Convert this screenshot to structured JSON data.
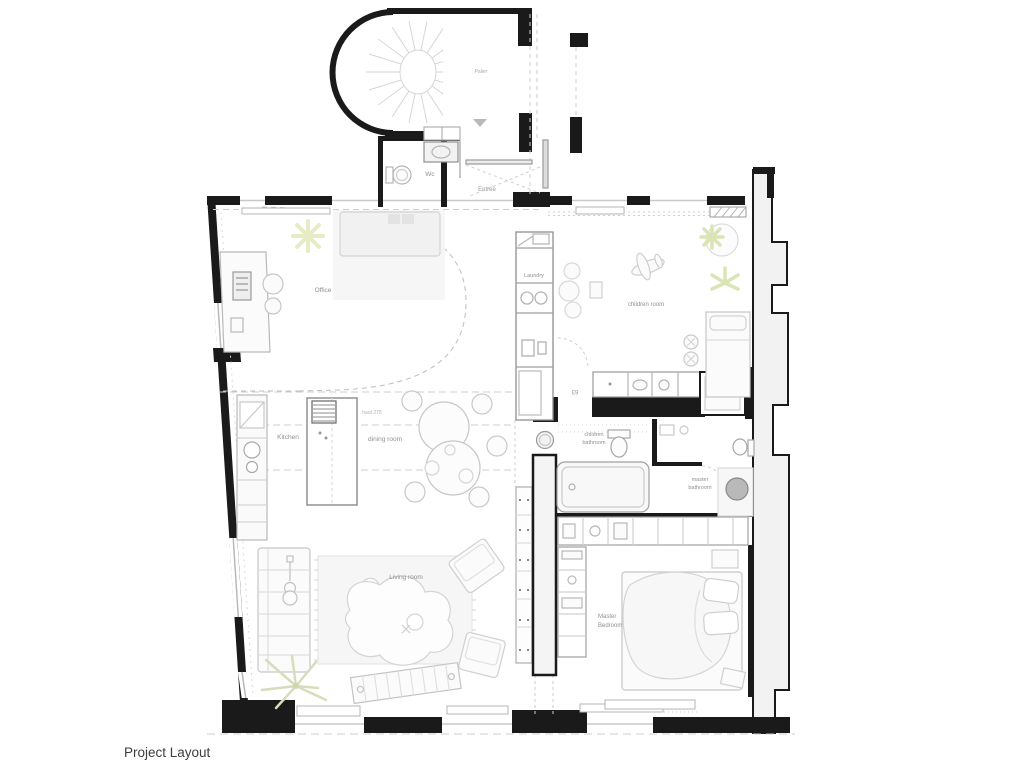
{
  "caption": "Project Layout",
  "rooms": {
    "palier": "Palier",
    "wc": "Wc",
    "entree": "Entrée",
    "office": "Office",
    "laundry": "Laundry",
    "children_room": "children room",
    "kitchen": "Kitchen",
    "dining_room": "dining room",
    "children_bathroom_line1": "children",
    "children_bathroom_line2": "bathroom",
    "master_bathroom_line1": "master",
    "master_bathroom_line2": "bathroom",
    "living_room": "Living room",
    "master_bedroom_line1": "Master",
    "master_bedroom_line2": "Bedroom"
  },
  "annotations": {
    "ceiling_height": "haut 275",
    "door_width": "63"
  },
  "colors": {
    "wall": "#1a1a1a",
    "party_wall_fill": "#f2f2f2",
    "furniture_stroke": "#c6c6c6",
    "fixture_stroke": "#a8a8a8",
    "dash": "#cfcfcf",
    "plant_yellow": "#e7ecc4",
    "plant_green": "#dbe4b4",
    "label": "#909090",
    "sink_fill": "#b9b9b9",
    "caption_color": "#3d3d3d"
  }
}
